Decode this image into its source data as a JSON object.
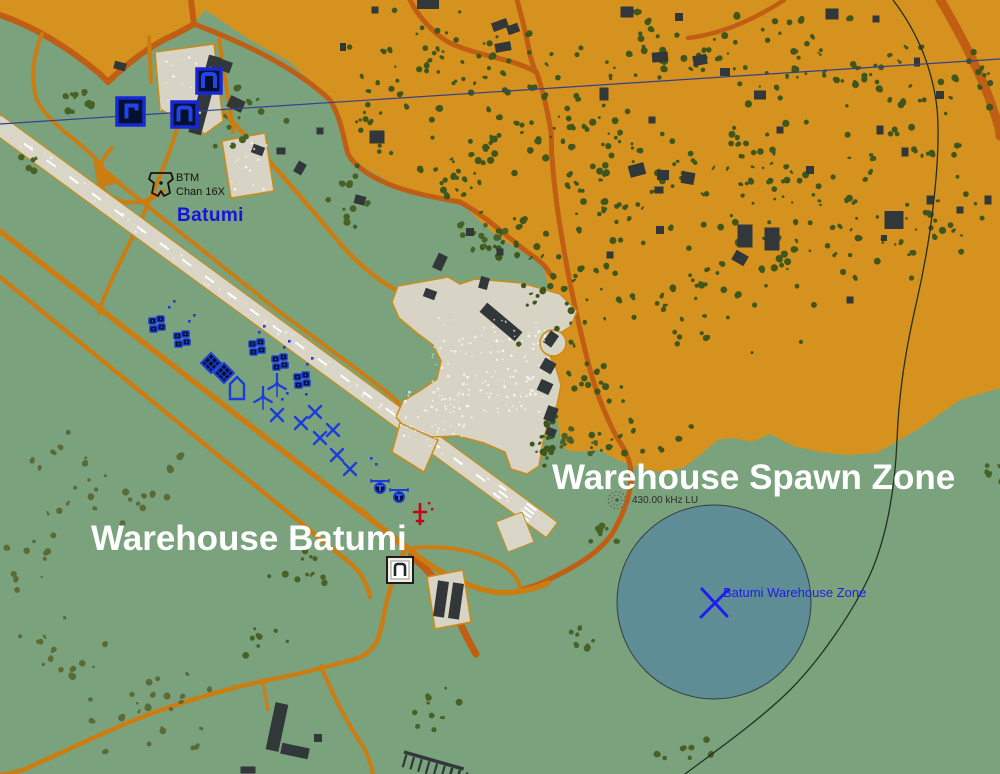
{
  "app": {
    "name": "Mission Editor Map"
  },
  "airport": {
    "name": "Batumi"
  },
  "beacons": {
    "tacan": {
      "id": "BTM",
      "channel": "Chan 16X"
    },
    "ndb": {
      "frequency": "430.00 kHz LU"
    }
  },
  "zones": {
    "warehouse_label": "Warehouse Batumi",
    "spawn_zone_label": "Warehouse Spawn Zone",
    "trigger_zone": {
      "name": "Batumi Warehouse Zone",
      "shape": "circle"
    }
  },
  "colors": {
    "terrain_green": "#79a27d",
    "urban_orange": "#d5921e",
    "road_major": "#c05f14",
    "road_minor": "#cc7d12",
    "surface": "#d9d6c7",
    "building": "#32383a",
    "tree_urban": "#3f561d",
    "tree_green": "#4a6126",
    "tree_light": "#5c6a36",
    "blue_coalition": "#1b3ed8",
    "red_coalition": "#c00712",
    "zone_fill": "#5d8c97",
    "powerline_blue": "#33418f",
    "label_white": "#ffffff",
    "label_blue": "#1414dc"
  },
  "icons": {
    "tacan": "tacan-beacon-icon",
    "ndb": "ndb-beacon-icon",
    "depot_square_gamma": "warehouse-depot-gamma-icon",
    "depot_square_n": "warehouse-depot-n-icon",
    "warehouse": "warehouse-icon",
    "vehicle_group": "vehicle-group-icon",
    "supply_diamond": "supply-point-icon",
    "bunker": "bunker-icon",
    "wind_turbine": "wind-turbine-icon",
    "aircraft": "aircraft-icon",
    "helicopter": "helicopter-icon",
    "red_unit": "red-coalition-unit-icon",
    "zone_cross": "zone-cross-icon"
  }
}
